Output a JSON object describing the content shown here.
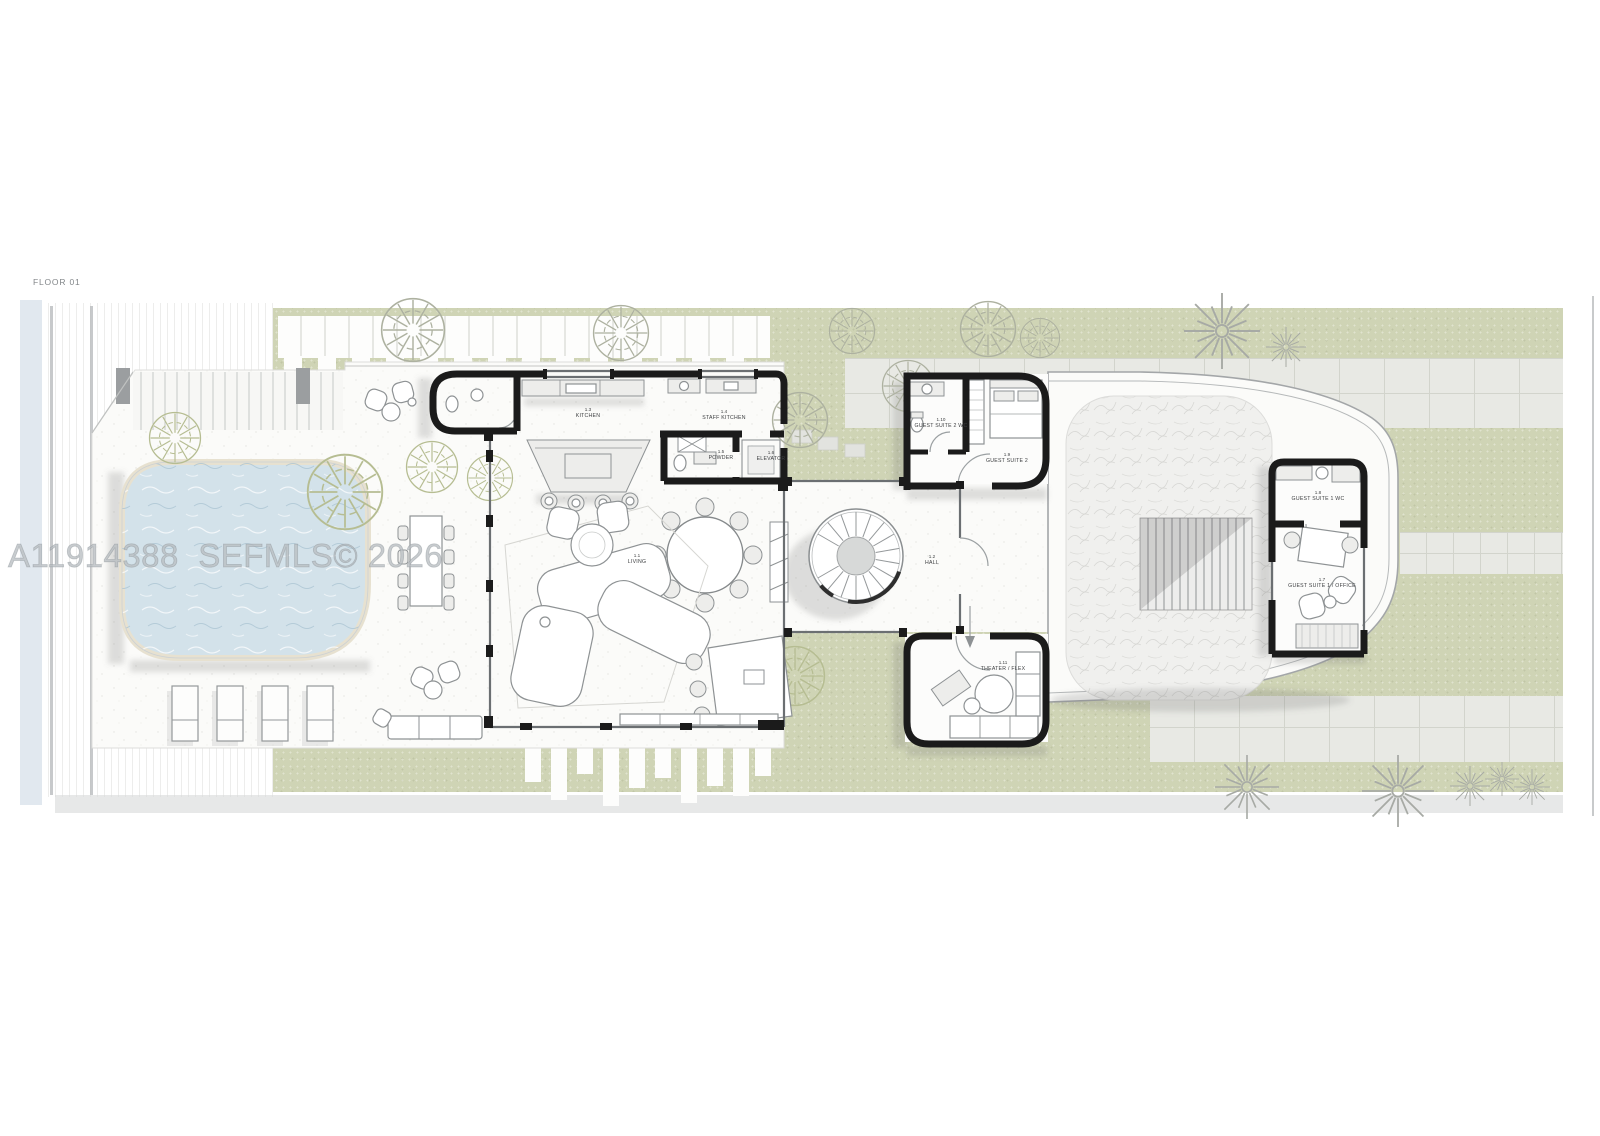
{
  "title": {
    "floor_label": "FLOOR 01"
  },
  "watermark": {
    "text": "A11914388  SEFMLS© 2026"
  },
  "rooms": [
    {
      "number": "1.1",
      "name": "LIVING"
    },
    {
      "number": "1.2",
      "name": "HALL"
    },
    {
      "number": "1.3",
      "name": "KITCHEN"
    },
    {
      "number": "1.4",
      "name": "STAFF KITCHEN"
    },
    {
      "number": "1.5",
      "name": "POWDER"
    },
    {
      "number": "1.6",
      "name": "ELEVATOR"
    },
    {
      "number": "1.7",
      "name": "GUEST SUITE 1 / OFFICE"
    },
    {
      "number": "1.8",
      "name": "GUEST SUITE 1 WC"
    },
    {
      "number": "1.9",
      "name": "GUEST SUITE 2"
    },
    {
      "number": "1.10",
      "name": "GUEST SUITE 2 WC"
    },
    {
      "number": "1.11",
      "name": "THEATER / FLEX"
    }
  ],
  "colors": {
    "page_bg": "#ffffff",
    "lawn_green": "#cfd4b5",
    "pool_water": "#d3e2ea",
    "pool_coping": "#e7e1d0",
    "wall_black": "#1b1b1b",
    "paver_gray": "#e8e9e4",
    "deck_white": "#fbfbf9",
    "water_strip": "#e1e8ef",
    "label_text": "#3c3e40",
    "watermark_gray": "#8d949b"
  }
}
